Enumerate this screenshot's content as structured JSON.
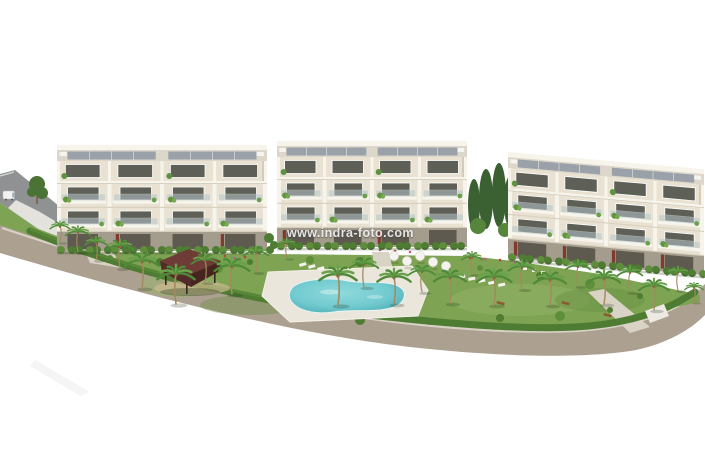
{
  "meta": {
    "type": "architectural-render-photo",
    "description": "Elevated 3D rendering of a new-build residential complex: three white modern apartment blocks with rooftop solar panels and planted balconies, landscaped tropical gardens with palm trees, a communal swimming pool with sun loungers and parasols, a dark timber pergola, perimeter hedge and access roads, isolated on a plain white background."
  },
  "watermark": {
    "text": "www.indra-foto.com"
  },
  "scene": {
    "building_count": 3,
    "elements": [
      "access-road",
      "service-van",
      "street-tree",
      "perimeter-road",
      "garden-lawn",
      "perimeter-hedge",
      "apartment-building-left",
      "apartment-building-center",
      "apartment-building-right",
      "cypress-trees",
      "pool-deck",
      "swimming-pool",
      "pergola",
      "sun-umbrellas",
      "sun-loungers",
      "palm-trees"
    ]
  },
  "palette": {
    "background": "#ffffff",
    "road": "#aca090",
    "road_curb": "#d8d2c6",
    "access_road": "#8f9193",
    "ramp": "#e4e2dd",
    "grass": "#7da353",
    "grass_light": "#93b468",
    "grass_dark": "#668c41",
    "hedge": "#4e7c33",
    "palm_leaf": "#69a24b",
    "palm_trunk": "#a5895f",
    "cypress": "#3b6132",
    "pool_water": "#72cbd0",
    "pool_deep": "#47a9b0",
    "pool_deck": "#eae6db",
    "facade": "#e9e2d2",
    "facade_trim": "#f7f4ec",
    "facade_shade": "#d3ccba",
    "glass": "#5e6057",
    "balcony_glass": "#b6c5c8",
    "roof_deck": "#dcd7ca",
    "solar_panel": "#9aa1a9",
    "ground_floor": "#a49d8d",
    "ground_opening": "#5f5a50",
    "door_accent": "#83392e",
    "pergola_roof": "#6e3b36",
    "pergola_dark": "#532b28",
    "furniture_white": "#f4f3ef",
    "flower_pink": "#c05c86",
    "flower_red": "#ad4a3c",
    "path": "#d9d3c5",
    "van_white": "#f2f2f2"
  }
}
